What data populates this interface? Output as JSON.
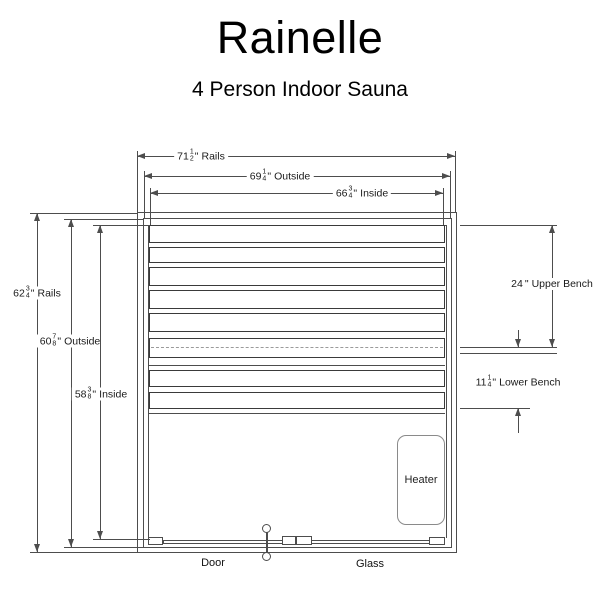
{
  "title": "Rainelle",
  "subtitle": "4 Person Indoor Sauna",
  "dims": {
    "top": [
      {
        "whole": "71",
        "num": "1",
        "den": "2",
        "unit": "\"",
        "label": "Rails"
      },
      {
        "whole": "69",
        "num": "1",
        "den": "4",
        "unit": "\"",
        "label": "Outside"
      },
      {
        "whole": "66",
        "num": "3",
        "den": "4",
        "unit": "\"",
        "label": "Inside"
      }
    ],
    "left": [
      {
        "whole": "62",
        "num": "3",
        "den": "4",
        "unit": "\"",
        "label": "Rails"
      },
      {
        "whole": "60",
        "num": "7",
        "den": "8",
        "unit": "\"",
        "label": "Outside"
      },
      {
        "whole": "58",
        "num": "3",
        "den": "8",
        "unit": "\"",
        "label": "Inside"
      }
    ],
    "right": [
      {
        "whole": "24",
        "num": "",
        "den": "",
        "unit": "\"",
        "label": "Upper Bench"
      },
      {
        "whole": "11",
        "num": "1",
        "den": "4",
        "unit": "\"",
        "label": "Lower Bench"
      }
    ]
  },
  "plan": {
    "heater_label": "Heater",
    "door_label": "Door",
    "glass_label": "Glass"
  },
  "colors": {
    "line": "#4d4d4d",
    "slat_border": "#3a3a3a",
    "dashed": "#9a9a9a",
    "text": "#1a1a1a",
    "background": "#ffffff"
  }
}
